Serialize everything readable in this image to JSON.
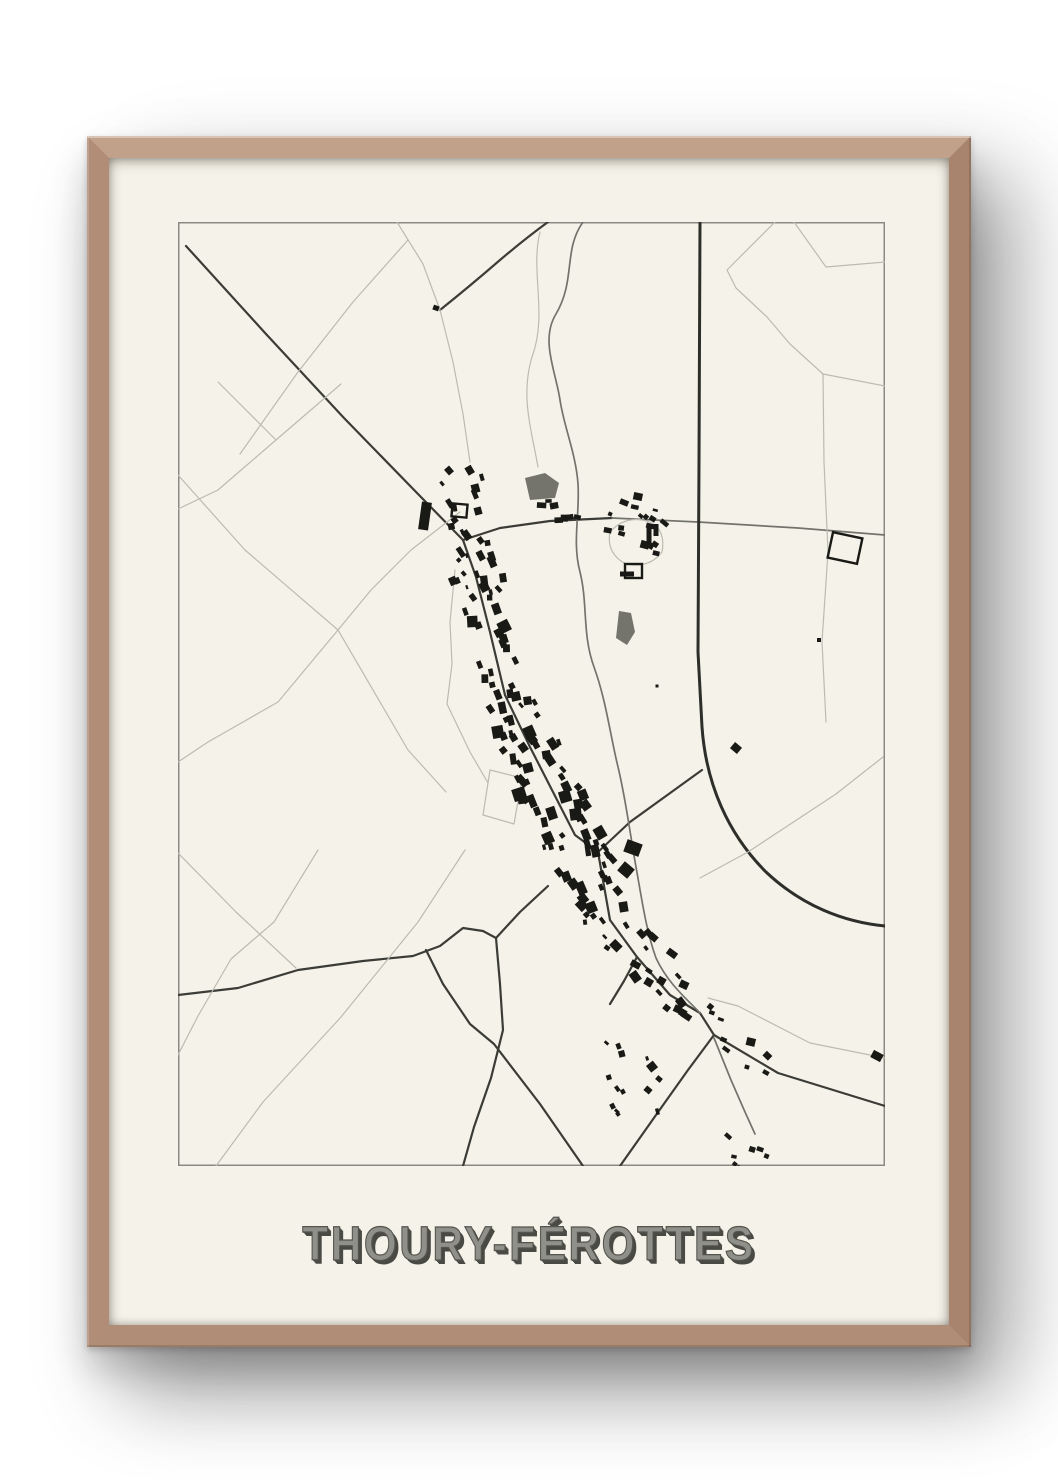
{
  "poster": {
    "title": "THOURY-FÉROTTES"
  },
  "colors": {
    "wall": "#ffffff",
    "paper": "#f5f3e9",
    "wood_top": "#c2a18b",
    "wood_left": "#b18c76",
    "wood_right": "#a8836d",
    "wood_bottom": "#b08d77",
    "map_border": "#8a8a84",
    "road_trunk": "#2e2e2a",
    "road_major": "#3c3c37",
    "road_medium": "#73736d",
    "road_light": "#bcbbb2",
    "building": "#191916",
    "patch": "#74746d",
    "title_fill": "#90908a",
    "title_shadow": "#4a4a44"
  },
  "map": {
    "width": 707,
    "height": 944,
    "widths": {
      "trunk": 3,
      "major": 2.2,
      "medium": 1.7,
      "light": 1.2
    },
    "patches": [
      "M347,256 L367,251 L381,261 L377,276 L352,278 Z",
      "M441,389 L453,391 L457,410 L449,423 L438,416 Z"
    ],
    "roads": [
      {
        "t": "major",
        "d": "M8,24 L88,112 L166,196 L240,272 L285,318"
      },
      {
        "t": "major",
        "d": "M285,318 L298,355 L312,410 L327,473"
      },
      {
        "t": "major",
        "d": "M285,318 L322,306 L372,299 L434,296"
      },
      {
        "t": "medium",
        "d": "M434,296 L520,300 L620,306 L707,313"
      },
      {
        "t": "trunk",
        "d": "M522,0 L521,240 L520,430 L524,505 C528,562 550,612 588,650 C624,684 666,700 707,704"
      },
      {
        "t": "major",
        "d": "M524,548 L488,574 L452,600 L420,630"
      },
      {
        "t": "major",
        "d": "M327,473 L352,525 L375,570 L397,613 L420,630 L432,698 L459,735 L492,773 L522,791 L536,813 L600,851 L707,884"
      },
      {
        "t": "major",
        "d": "M459,735 L446,759 L432,782"
      },
      {
        "t": "major",
        "d": "M536,813 L510,848 L478,893 L442,944"
      },
      {
        "t": "major",
        "d": "M0,773 L60,766 L120,748 L185,739 L235,734 L262,724 L285,706 L305,709 L318,716"
      },
      {
        "t": "major",
        "d": "M318,716 L322,762 L325,808 L313,856 L296,905 L285,944"
      },
      {
        "t": "major",
        "d": "M318,716 L342,690 L370,664"
      },
      {
        "t": "major",
        "d": "M248,728 L265,762 L292,802 L316,822 L362,882 L405,944"
      },
      {
        "t": "major",
        "d": "M370,0 Q348,16 322,38 Q292,64 262,88"
      },
      {
        "t": "medium",
        "d": "M405,0 C385,28 398,58 378,92 C362,118 378,150 382,178 C386,205 398,232 400,262 C402,292 394,320 402,350 C410,382 404,412 416,445 C428,478 432,512 440,545 C448,578 452,612 458,645 C464,678 468,708 478,736 C490,762 510,778 522,791"
      },
      {
        "t": "medium",
        "d": "M536,816 L553,858 L567,890 L577,912"
      },
      {
        "t": "light",
        "d": "M40,160 L98,218 L163,162"
      },
      {
        "t": "light",
        "d": "M98,218 L40,268 L0,287"
      },
      {
        "t": "light",
        "d": "M230,18 L175,80 L120,150 L62,232"
      },
      {
        "t": "light",
        "d": "M0,253 L67,328 L160,408 L230,528 L268,570"
      },
      {
        "t": "light",
        "d": "M282,290 L233,328 L193,368 L160,408"
      },
      {
        "t": "light",
        "d": "M160,408 L100,480 L30,520 L0,540"
      },
      {
        "t": "light",
        "d": "M0,631 L58,690 L118,746"
      },
      {
        "t": "light",
        "d": "M287,628 L240,700 L163,795 L85,880 L38,944"
      },
      {
        "t": "light",
        "d": "M140,628 L96,700 L53,737 L20,794 L0,833"
      },
      {
        "t": "light",
        "d": "M597,0 L549,48 L558,66 L589,95 L612,122 L645,152 L707,164"
      },
      {
        "t": "light",
        "d": "M645,152 L646,240 L650,330 L644,420 L648,500"
      },
      {
        "t": "light",
        "d": "M616,0 L648,45 L707,40"
      },
      {
        "t": "light",
        "d": "M705,535 L658,572 L570,630 L522,656"
      },
      {
        "t": "light",
        "d": "M432,310 Q448,292 472,300 Q488,308 484,330 Q470,348 446,341 Q428,330 432,310"
      },
      {
        "t": "light",
        "d": "M312,548 L344,556 L336,602 L305,593 Z"
      },
      {
        "t": "light",
        "d": "M262,88 L275,140 L285,192 L292,240"
      },
      {
        "t": "light",
        "d": "M219,0 L245,42 L262,88"
      },
      {
        "t": "light",
        "d": "M362,10 C352,50 370,92 354,135 C342,175 354,210 360,245"
      },
      {
        "t": "light",
        "d": "M277,348 L272,400 L274,442 L269,482 L292,530 L310,561"
      },
      {
        "t": "light",
        "d": "M530,776 L560,784 L632,821 L707,836"
      }
    ],
    "outline_buildings": [
      [
        652,
        313,
        30,
        26,
        12
      ],
      [
        447,
        342,
        17,
        14,
        0
      ],
      [
        274,
        282,
        15,
        13,
        5
      ]
    ],
    "buildings": [
      [
        247,
        294,
        10,
        28,
        8
      ],
      [
        455,
        626,
        16,
        13,
        20
      ],
      [
        448,
        648,
        13,
        12,
        40
      ],
      [
        471,
        315,
        5,
        22,
        0
      ],
      [
        478,
        308,
        5,
        12,
        0
      ],
      [
        449,
        352,
        14,
        5,
        0
      ],
      [
        699,
        834,
        11,
        8,
        28
      ],
      [
        558,
        526,
        9,
        8,
        40
      ],
      [
        641,
        418,
        4,
        4,
        0
      ],
      [
        479,
        464,
        3,
        3,
        0
      ],
      [
        258,
        86,
        6,
        5,
        20
      ],
      [
        470,
        868,
        7,
        6,
        40
      ],
      [
        481,
        857,
        6,
        5,
        40
      ]
    ],
    "clusters": [
      {
        "name": "main-street",
        "line": [
          [
            327,
            473
          ],
          [
            432,
            698
          ]
        ],
        "count": 80,
        "spread": 24,
        "size": [
          5,
          13
        ],
        "angle": 65
      },
      {
        "name": "upper-street",
        "line": [
          [
            289,
            326
          ],
          [
            327,
            473
          ]
        ],
        "count": 26,
        "spread": 19,
        "size": [
          5,
          12
        ],
        "angle": 72
      },
      {
        "name": "south-street",
        "line": [
          [
            436,
            702
          ],
          [
            520,
            788
          ]
        ],
        "count": 22,
        "spread": 17,
        "size": [
          4,
          11
        ],
        "angle": 42
      },
      {
        "name": "south-scatter",
        "line": [
          [
            445,
            815
          ],
          [
            468,
            898
          ]
        ],
        "count": 12,
        "spread": 26,
        "size": [
          4,
          9
        ],
        "angle": 60
      },
      {
        "name": "ne-hamlet",
        "line": [
          [
            438,
            284
          ],
          [
            486,
            322
          ]
        ],
        "count": 18,
        "spread": 20,
        "size": [
          4,
          9
        ],
        "angle": 25
      },
      {
        "name": "north-hamlet",
        "line": [
          [
            280,
            242
          ],
          [
            310,
            378
          ]
        ],
        "count": 24,
        "spread": 16,
        "size": [
          4,
          10
        ],
        "angle": 65
      },
      {
        "name": "mid-row",
        "line": [
          [
            363,
            291
          ],
          [
            399,
            286
          ]
        ],
        "count": 7,
        "spread": 7,
        "size": [
          6,
          11
        ],
        "angle": 5
      },
      {
        "name": "se-road",
        "line": [
          [
            520,
            790
          ],
          [
            597,
            847
          ]
        ],
        "count": 9,
        "spread": 13,
        "size": [
          4,
          9
        ],
        "angle": 28
      },
      {
        "name": "bottom-cluster",
        "line": [
          [
            546,
            926
          ],
          [
            590,
            940
          ]
        ],
        "count": 7,
        "spread": 9,
        "size": [
          4,
          8
        ],
        "angle": 25
      }
    ]
  }
}
